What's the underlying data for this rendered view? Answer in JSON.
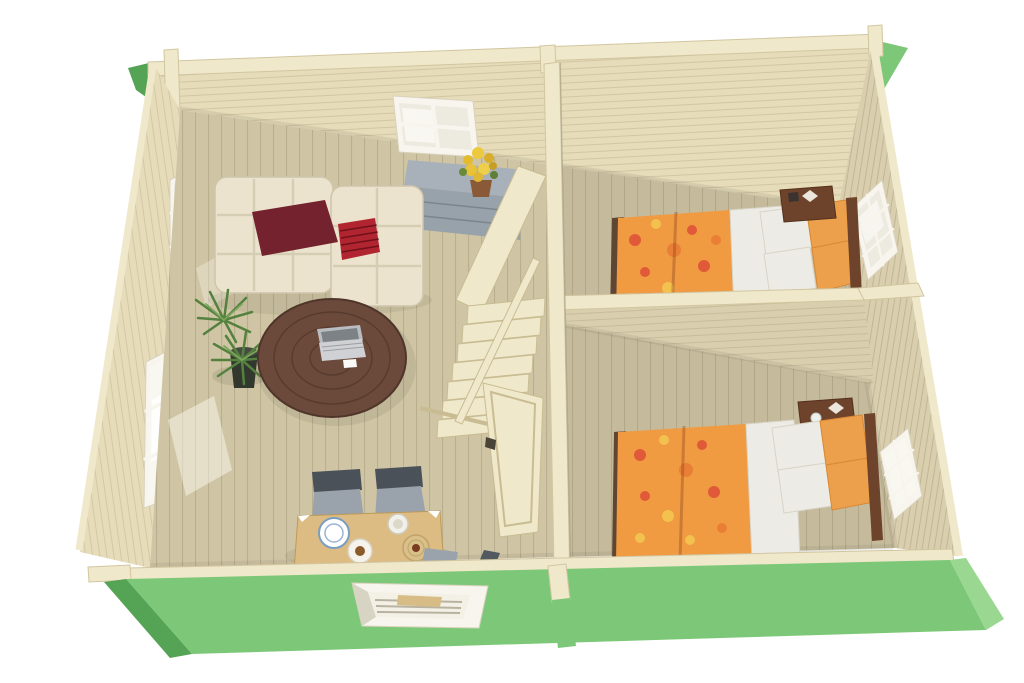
{
  "scene": {
    "subject": "Cutaway top view 3D render of a green wooden cabin floor plan with living room, staircase and two bedrooms",
    "style": "isometric cutaway architectural render, white background",
    "rooms": [
      {
        "label": "living-room",
        "items": [
          "cream tufted corner sofa",
          "dark maroon pillow",
          "red striped pillow",
          "round dark wood coffee table",
          "open laptop",
          "green potted plant",
          "grey sideboard with drawers",
          "pot of yellow flowers",
          "light wood dining table",
          "two grey dining chairs",
          "blue rimmed plate",
          "cup and saucer",
          "plate with food",
          "woven placemat"
        ]
      },
      {
        "label": "bedroom-top",
        "items": [
          "double bed",
          "orange floral duvet",
          "white linen",
          "two white pillows",
          "two orange pillows",
          "dark wood nightstand",
          "side window"
        ]
      },
      {
        "label": "bedroom-bottom",
        "items": [
          "double bed",
          "orange floral duvet",
          "white linen",
          "two white pillows",
          "two orange pillows",
          "dark wood nightstand",
          "side window"
        ]
      }
    ],
    "features": [
      "wooden staircase with banister and railing",
      "open interior door",
      "back wall window",
      "two windows on left wall",
      "window in green front wall",
      "green exterior walls",
      "vertical plank wood floors",
      "horizontal plank interior walls"
    ]
  },
  "colors": {
    "background": "#ffffff",
    "exterior_green": "#7dc878",
    "exterior_green_dark": "#55a355",
    "exterior_green_light": "#9ad892",
    "wall_wood": "#e6dcba",
    "wall_wood_shaded": "#d9cfae",
    "beam_wood": "#f0e8ca",
    "floor_wood": "#cfc5a4",
    "sofa_cream": "#ebe3cd",
    "pillow_maroon": "#73222e",
    "pillow_red": "#b0252f",
    "table_brown": "#6b4a3c",
    "dining_wood": "#dcbc82",
    "chair_gray": "#9aa2ab",
    "chair_dark": "#4a5158",
    "cabinet_gray": "#98a2ab",
    "plant_green": "#55813f",
    "pot_dark": "#33382f",
    "duvet_orange": "#f09a42",
    "duvet_floral_red": "#e05a3a",
    "duvet_floral_yellow": "#f2c14e",
    "linen_white": "#ecebe6",
    "nightstand_brown": "#6e432c",
    "window_frame": "#f7f5ee",
    "glass_tint": "#edeadf"
  }
}
